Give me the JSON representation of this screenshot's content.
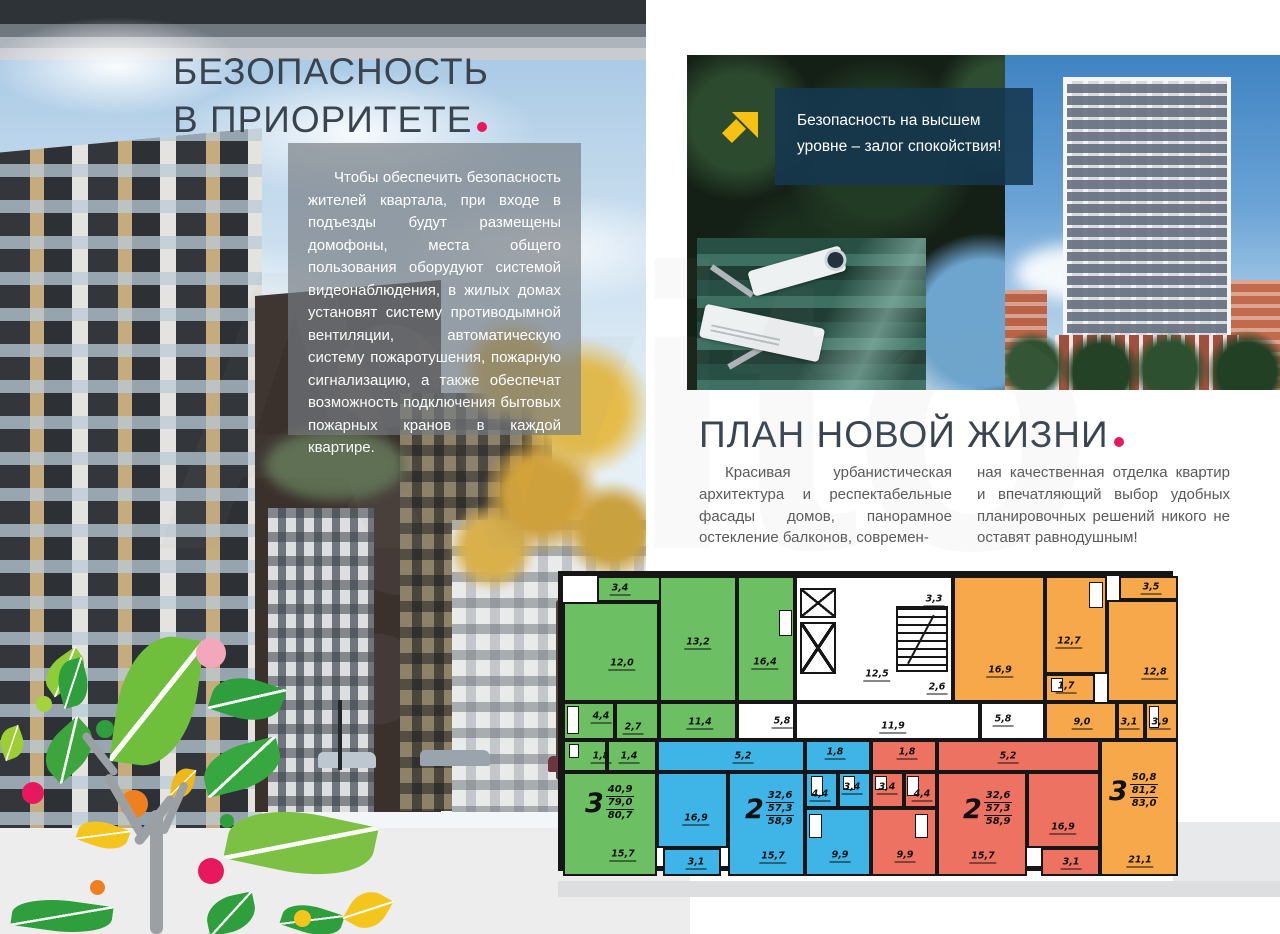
{
  "colors": {
    "accent_pink": "#e8185e",
    "heading_text": "#39444f",
    "body_text": "#58595b",
    "panel_bg": "rgba(118,124,129,0.68)",
    "callout_bg": "rgba(20,55,79,0.88)",
    "arrow_yellow": "#f6c110",
    "apartment_green": "#6cc063",
    "apartment_blue": "#3eb5e6",
    "apartment_red": "#ee7261",
    "apartment_orange": "#f6a84b",
    "wall_black": "#161616",
    "white": "#ffffff"
  },
  "watermark": "Avito",
  "security": {
    "title_line1": "БЕЗОПАСНОСТЬ",
    "title_line2": "В ПРИОРИТЕТЕ",
    "body": "Чтобы обеспечить безопасность жителей квартала, при входе в подъезды будут размещены домофоны, места общего пользования оборудуют системой видеонаблюдения, в жилых домах установят систему противодымной вентиляции, автоматическую систему пожаротушения, пожарную сигнализацию, а также обеспечат возможность подключения бытовых пожарных кранов в каждой квартире."
  },
  "callout": {
    "line1": "Безопасность на высшем",
    "line2": "уровне – залог спокойствия!"
  },
  "plan_section": {
    "title": "ПЛАН НОВОЙ ЖИЗНИ",
    "col1": "Красивая урбанистическая архитектура и респектабельные фасады домов, панорамное остекление балконов, современ-",
    "col2": "ная качественная отделка квартир и впечатляющий выбор удобных планировочных решений никого не оставят равнодушным!"
  },
  "floorplan": {
    "apartments": [
      {
        "name": "3-room-left",
        "type_label": "3",
        "living_area": "40,9",
        "apartment_area": "79,0",
        "total_area": "80,7",
        "color": "apartment_green",
        "pos": [
          22,
          208
        ]
      },
      {
        "name": "2-room-center-left",
        "type_label": "2",
        "living_area": "32,6",
        "apartment_area": "57,3",
        "total_area": "58,9",
        "color": "apartment_blue",
        "pos": [
          182,
          214
        ]
      },
      {
        "name": "2-room-center-right",
        "type_label": "2",
        "living_area": "32,6",
        "apartment_area": "57,3",
        "total_area": "58,9",
        "color": "apartment_red",
        "pos": [
          400,
          214
        ]
      },
      {
        "name": "3-room-right",
        "type_label": "3",
        "living_area": "50,8",
        "apartment_area": "81,2",
        "total_area": "83,0",
        "color": "apartment_orange",
        "pos": [
          546,
          196
        ]
      }
    ],
    "rooms": [
      {
        "label": "3,4",
        "rect": [
          34,
          0,
          74,
          26
        ],
        "color": "apartment_green",
        "lpos": [
          57,
          13
        ]
      },
      {
        "label": "12,0",
        "rect": [
          0,
          26,
          96,
          100
        ],
        "color": "apartment_green",
        "lpos": [
          59,
          88
        ]
      },
      {
        "label": "13,2",
        "rect": [
          96,
          0,
          78,
          126
        ],
        "color": "apartment_green",
        "lpos": [
          135,
          67
        ]
      },
      {
        "label": "16,4",
        "rect": [
          174,
          0,
          58,
          126
        ],
        "color": "apartment_green",
        "lpos": [
          202,
          87
        ]
      },
      {
        "label": "4,4",
        "rect": [
          0,
          126,
          52,
          38
        ],
        "color": "apartment_green",
        "lpos": [
          38,
          141
        ]
      },
      {
        "label": "2,7",
        "rect": [
          52,
          126,
          44,
          38
        ],
        "color": "apartment_green",
        "lpos": [
          70,
          152
        ]
      },
      {
        "label": "11,4",
        "rect": [
          96,
          126,
          78,
          38
        ],
        "color": "apartment_green",
        "lpos": [
          137,
          147
        ]
      },
      {
        "label": "1,8",
        "rect": [
          0,
          164,
          44,
          32
        ],
        "color": "apartment_green",
        "lpos": [
          38,
          181
        ]
      },
      {
        "label": "1,4",
        "rect": [
          44,
          164,
          50,
          32
        ],
        "color": "apartment_green",
        "lpos": [
          66,
          181
        ]
      },
      {
        "label": "15,7",
        "rect": [
          0,
          196,
          94,
          104
        ],
        "color": "apartment_green",
        "lpos": [
          60,
          279
        ]
      },
      {
        "label": "5,2",
        "rect": [
          94,
          164,
          148,
          32
        ],
        "color": "apartment_blue",
        "lpos": [
          180,
          181
        ]
      },
      {
        "label": "16,9",
        "rect": [
          94,
          196,
          71,
          76
        ],
        "color": "apartment_blue",
        "lpos": [
          133,
          243
        ]
      },
      {
        "label": "3,1",
        "rect": [
          100,
          272,
          58,
          28
        ],
        "color": "apartment_blue",
        "lpos": [
          133,
          287
        ]
      },
      {
        "label": "15,7",
        "rect": [
          165,
          196,
          77,
          104
        ],
        "color": "apartment_blue",
        "lpos": [
          210,
          281
        ]
      },
      {
        "label": "1,8",
        "rect": [
          242,
          164,
          66,
          32
        ],
        "color": "apartment_blue",
        "lpos": [
          272,
          177
        ]
      },
      {
        "label": "4,4",
        "rect": [
          242,
          196,
          33,
          36
        ],
        "color": "apartment_blue",
        "lpos": [
          257,
          219
        ]
      },
      {
        "label": "3,4",
        "rect": [
          275,
          196,
          33,
          36
        ],
        "color": "apartment_blue",
        "lpos": [
          289,
          212
        ]
      },
      {
        "label": "9,9",
        "rect": [
          242,
          232,
          66,
          68
        ],
        "color": "apartment_blue",
        "lpos": [
          277,
          280
        ]
      },
      {
        "label": "1,8",
        "rect": [
          308,
          164,
          66,
          32
        ],
        "color": "apartment_red",
        "lpos": [
          344,
          177
        ]
      },
      {
        "label": "3,4",
        "rect": [
          308,
          196,
          33,
          36
        ],
        "color": "apartment_red",
        "lpos": [
          324,
          212
        ]
      },
      {
        "label": "4,4",
        "rect": [
          341,
          196,
          33,
          36
        ],
        "color": "apartment_red",
        "lpos": [
          359,
          219
        ]
      },
      {
        "label": "9,9",
        "rect": [
          308,
          232,
          66,
          68
        ],
        "color": "apartment_red",
        "lpos": [
          342,
          280
        ]
      },
      {
        "label": "5,2",
        "rect": [
          374,
          164,
          163,
          32
        ],
        "color": "apartment_red",
        "lpos": [
          445,
          181
        ]
      },
      {
        "label": "15,7",
        "rect": [
          374,
          196,
          90,
          104
        ],
        "color": "apartment_red",
        "lpos": [
          420,
          281
        ]
      },
      {
        "label": "16,9",
        "rect": [
          464,
          196,
          73,
          76
        ],
        "color": "apartment_red",
        "lpos": [
          500,
          252
        ]
      },
      {
        "label": "3,1",
        "rect": [
          478,
          272,
          59,
          28
        ],
        "color": "apartment_red",
        "lpos": [
          508,
          287
        ]
      },
      {
        "label": "16,9",
        "rect": [
          390,
          0,
          92,
          126
        ],
        "color": "apartment_orange",
        "lpos": [
          437,
          95
        ]
      },
      {
        "label": "12,7",
        "rect": [
          482,
          0,
          62,
          98
        ],
        "color": "apartment_orange",
        "lpos": [
          506,
          66
        ]
      },
      {
        "label": "1,7",
        "rect": [
          482,
          98,
          50,
          28
        ],
        "color": "apartment_orange",
        "lpos": [
          503,
          111
        ]
      },
      {
        "label": "3,5",
        "rect": [
          556,
          0,
          59,
          24
        ],
        "color": "apartment_orange",
        "lpos": [
          588,
          12
        ]
      },
      {
        "label": "12,8",
        "rect": [
          544,
          24,
          71,
          102
        ],
        "color": "apartment_orange",
        "lpos": [
          592,
          97
        ]
      },
      {
        "label": "9,0",
        "rect": [
          482,
          126,
          72,
          38
        ],
        "color": "apartment_orange",
        "lpos": [
          519,
          147
        ]
      },
      {
        "label": "3,1",
        "rect": [
          554,
          126,
          28,
          38
        ],
        "color": "apartment_orange",
        "lpos": [
          566,
          147
        ]
      },
      {
        "label": "3,9",
        "rect": [
          582,
          126,
          33,
          38
        ],
        "color": "apartment_orange",
        "lpos": [
          597,
          147
        ]
      },
      {
        "label": "21,1",
        "rect": [
          537,
          164,
          78,
          136
        ],
        "color": "apartment_orange",
        "lpos": [
          577,
          285
        ]
      },
      {
        "label": "",
        "rect": [
          390,
          126,
          27,
          38
        ],
        "color": "apartment_orange",
        "lpos": null
      },
      {
        "label": "",
        "rect": [
          232,
          0,
          158,
          126
        ],
        "color": "white",
        "lpos": null
      },
      {
        "label": "",
        "rect": [
          174,
          126,
          58,
          38
        ],
        "color": "white",
        "lpos": null
      },
      {
        "label": "",
        "rect": [
          232,
          126,
          185,
          38
        ],
        "color": "white",
        "lpos": null
      },
      {
        "label": "",
        "rect": [
          417,
          126,
          65,
          38
        ],
        "color": "white",
        "lpos": null
      }
    ],
    "common_labels": [
      {
        "label": "3,3",
        "lpos": [
          371,
          24
        ]
      },
      {
        "label": "12,5",
        "lpos": [
          314,
          99
        ]
      },
      {
        "label": "2,6",
        "lpos": [
          374,
          112
        ]
      },
      {
        "label": "5,8",
        "lpos": [
          219,
          146
        ]
      },
      {
        "label": "11,9",
        "lpos": [
          330,
          151
        ]
      },
      {
        "label": "5,8",
        "lpos": [
          440,
          144
        ]
      }
    ]
  }
}
